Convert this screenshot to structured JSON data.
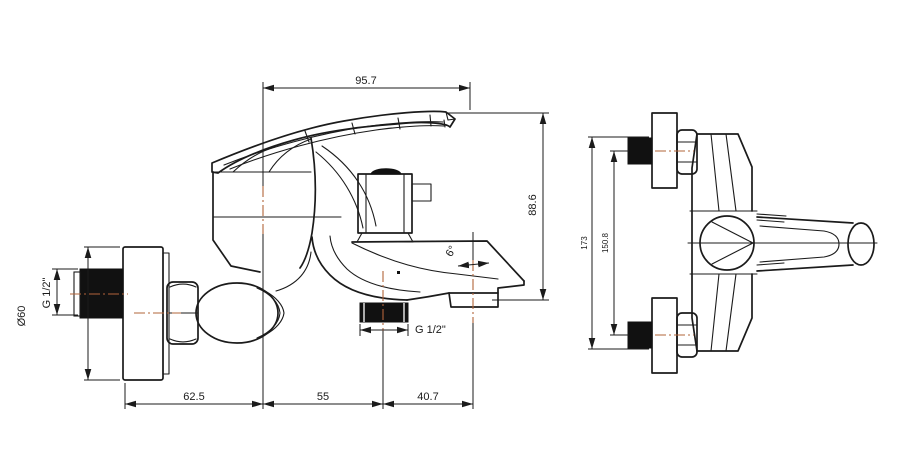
{
  "colors": {
    "background": "#ffffff",
    "line": "#1b1b1b",
    "centerline": "#b2643a",
    "solid_fill": "#111111"
  },
  "left_view": {
    "dims": {
      "top_width": "95.7",
      "height": "88.6",
      "flange_diameter": "Ø60",
      "wall_thread": "G 1/2\"",
      "outlet_thread": "G 1/2\"",
      "spout_angle": "6°",
      "seg_flange": "62.5",
      "seg_body": "55",
      "seg_spout": "40.7"
    }
  },
  "right_view": {
    "dims": {
      "overall": "173",
      "hole_centers": "150.8"
    }
  }
}
